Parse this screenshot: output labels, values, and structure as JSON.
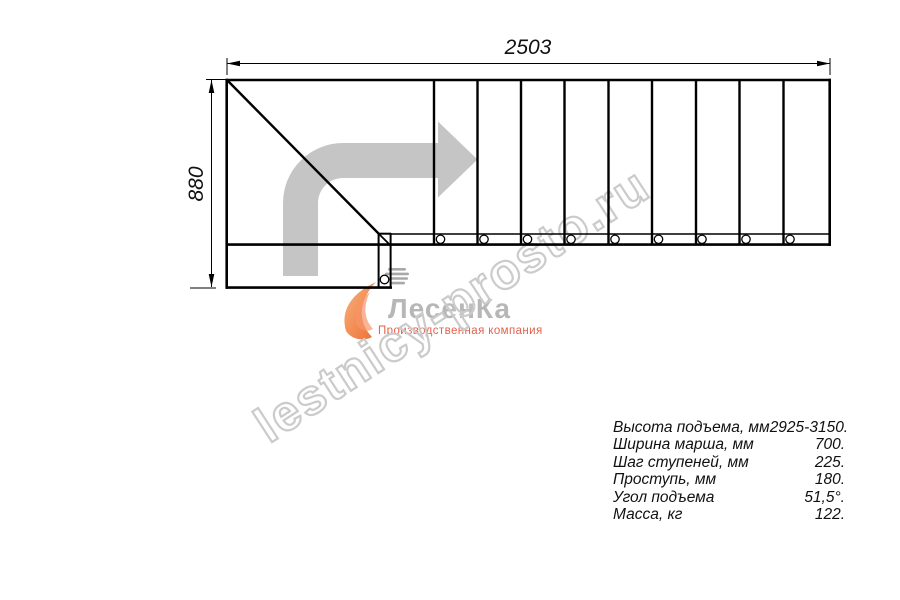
{
  "drawing": {
    "width_mm": "2503",
    "height_mm": "880",
    "step_circle_count": 9,
    "icons": {
      "direction_arrow": "thick-gray-right-turn-arrow",
      "flame_icon": "orange-flame",
      "stairs_icon": "gray-stair-bars"
    }
  },
  "watermark": {
    "text": "lestnicy-prosto.ru"
  },
  "logo": {
    "name": "ЛесенКа",
    "tagline": "Производственная компания"
  },
  "specs": {
    "rows": [
      {
        "label": "Высота подъема, мм",
        "value": "2925-3150."
      },
      {
        "label": "Ширина марша, мм",
        "value": "700."
      },
      {
        "label": "Шаг ступеней, мм",
        "value": "225."
      },
      {
        "label": "Проступь, мм",
        "value": "180."
      },
      {
        "label": "Угол подъема",
        "value": "51,5°."
      },
      {
        "label": "Масса, кг",
        "value": "122."
      }
    ]
  },
  "colors": {
    "line": "#000000",
    "arrow_gray": "#c5c5c5",
    "watermark_gray": "#cbcbcb",
    "logo_gray": "#b7b7b7",
    "logo_accent": "#e4614b",
    "flame_light": "#f9b27e",
    "flame_dark": "#ed6f34"
  }
}
